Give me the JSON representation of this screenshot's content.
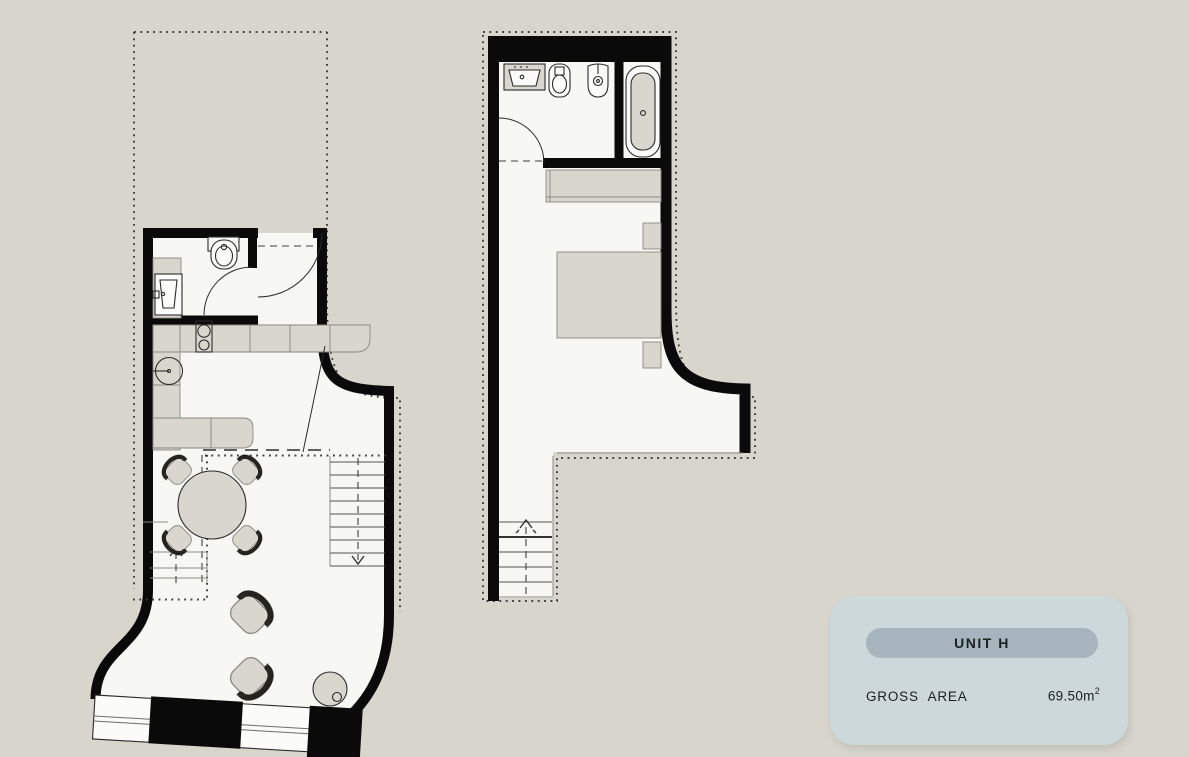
{
  "colors": {
    "page_bg": "#d8d5cd",
    "floor": "#f7f7f4",
    "furniture": "#d9d6ce",
    "wall": "#0a0a0a",
    "card_bg": "#ccd8da",
    "card_pill": "#a6b5bd",
    "card_text": "#1b2023"
  },
  "card": {
    "title": "UNIT H",
    "gross_area_label": "GROSS AREA",
    "gross_area_value": "69.50m",
    "gross_area_exponent": "2"
  },
  "plans": {
    "lower": {
      "fixtures": [
        "toilet-icon",
        "washbasin-icon",
        "bathroom-door-arc",
        "entry-door-arc",
        "kitchen-counter",
        "cooktop-icon",
        "kitchen-sink-icon",
        "dining-table",
        "dining-chair",
        "armchair",
        "side-table",
        "staircase-down",
        "stair-down-arrow",
        "stair-up-arrow",
        "mezzanine-dotted-outline",
        "curved-window-wall",
        "plot-dotted-boundary"
      ]
    },
    "upper": {
      "fixtures": [
        "washbasin-icon",
        "toilet-icon",
        "bidet-icon",
        "bathtub-icon",
        "bathroom-door-arc",
        "wardrobe",
        "double-bed",
        "nightstand",
        "staircase-up",
        "stair-up-arrow",
        "plot-dotted-boundary"
      ]
    }
  }
}
